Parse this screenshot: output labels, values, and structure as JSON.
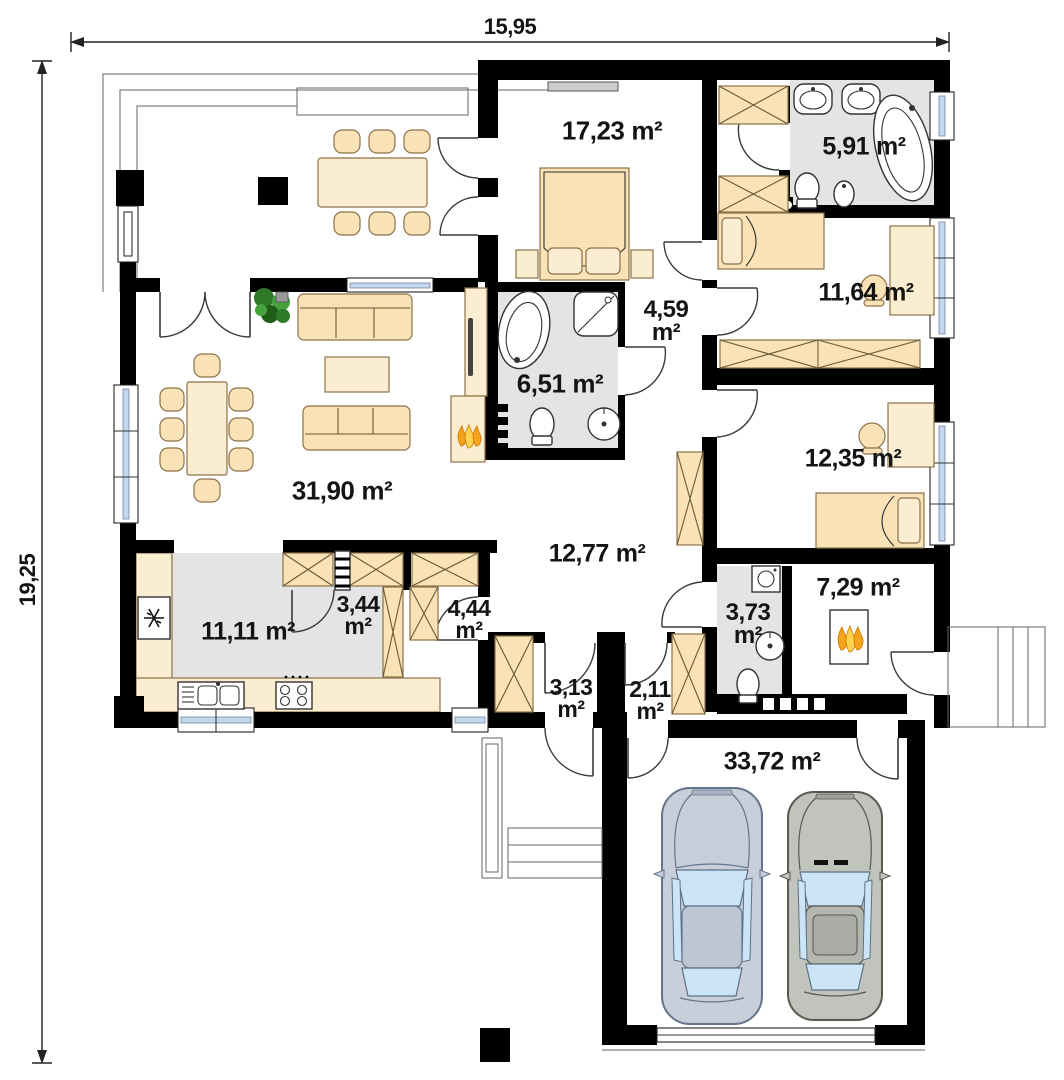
{
  "plan": {
    "dimensions": {
      "width_label": "15,95",
      "height_label": "19,25"
    },
    "rooms": {
      "bedroom1": {
        "value": "17,23",
        "unit": "m²"
      },
      "bathroom1": {
        "value": "5,91",
        "unit": "m²"
      },
      "bedroom2": {
        "value": "11,64",
        "unit": "m²"
      },
      "hall1": {
        "value": "4,59",
        "unit": "m²"
      },
      "bathroom2": {
        "value": "6,51",
        "unit": "m²"
      },
      "bedroom3": {
        "value": "12,35",
        "unit": "m²"
      },
      "living": {
        "value": "31,90",
        "unit": "m²"
      },
      "corridor": {
        "value": "12,77",
        "unit": "m²"
      },
      "kitchen": {
        "value": "11,11",
        "unit": "m²"
      },
      "pantry": {
        "value": "3,44",
        "unit": "m²"
      },
      "wardrobe": {
        "value": "4,44",
        "unit": "m²"
      },
      "hall2": {
        "value": "3,13",
        "unit": "m²"
      },
      "vestibule": {
        "value": "2,11",
        "unit": "m²"
      },
      "wc": {
        "value": "3,73",
        "unit": "m²"
      },
      "boiler": {
        "value": "7,29",
        "unit": "m²"
      },
      "garage": {
        "value": "33,72",
        "unit": "m²"
      }
    },
    "colors": {
      "wall": "#000000",
      "furniture": "#F9E2B5",
      "floor_gray": "#E4E4E4",
      "window_glass": "#C3D7EF",
      "flame": "#F5A31C",
      "car_left": "#C9CFDA",
      "car_right": "#C1C3BD"
    }
  }
}
